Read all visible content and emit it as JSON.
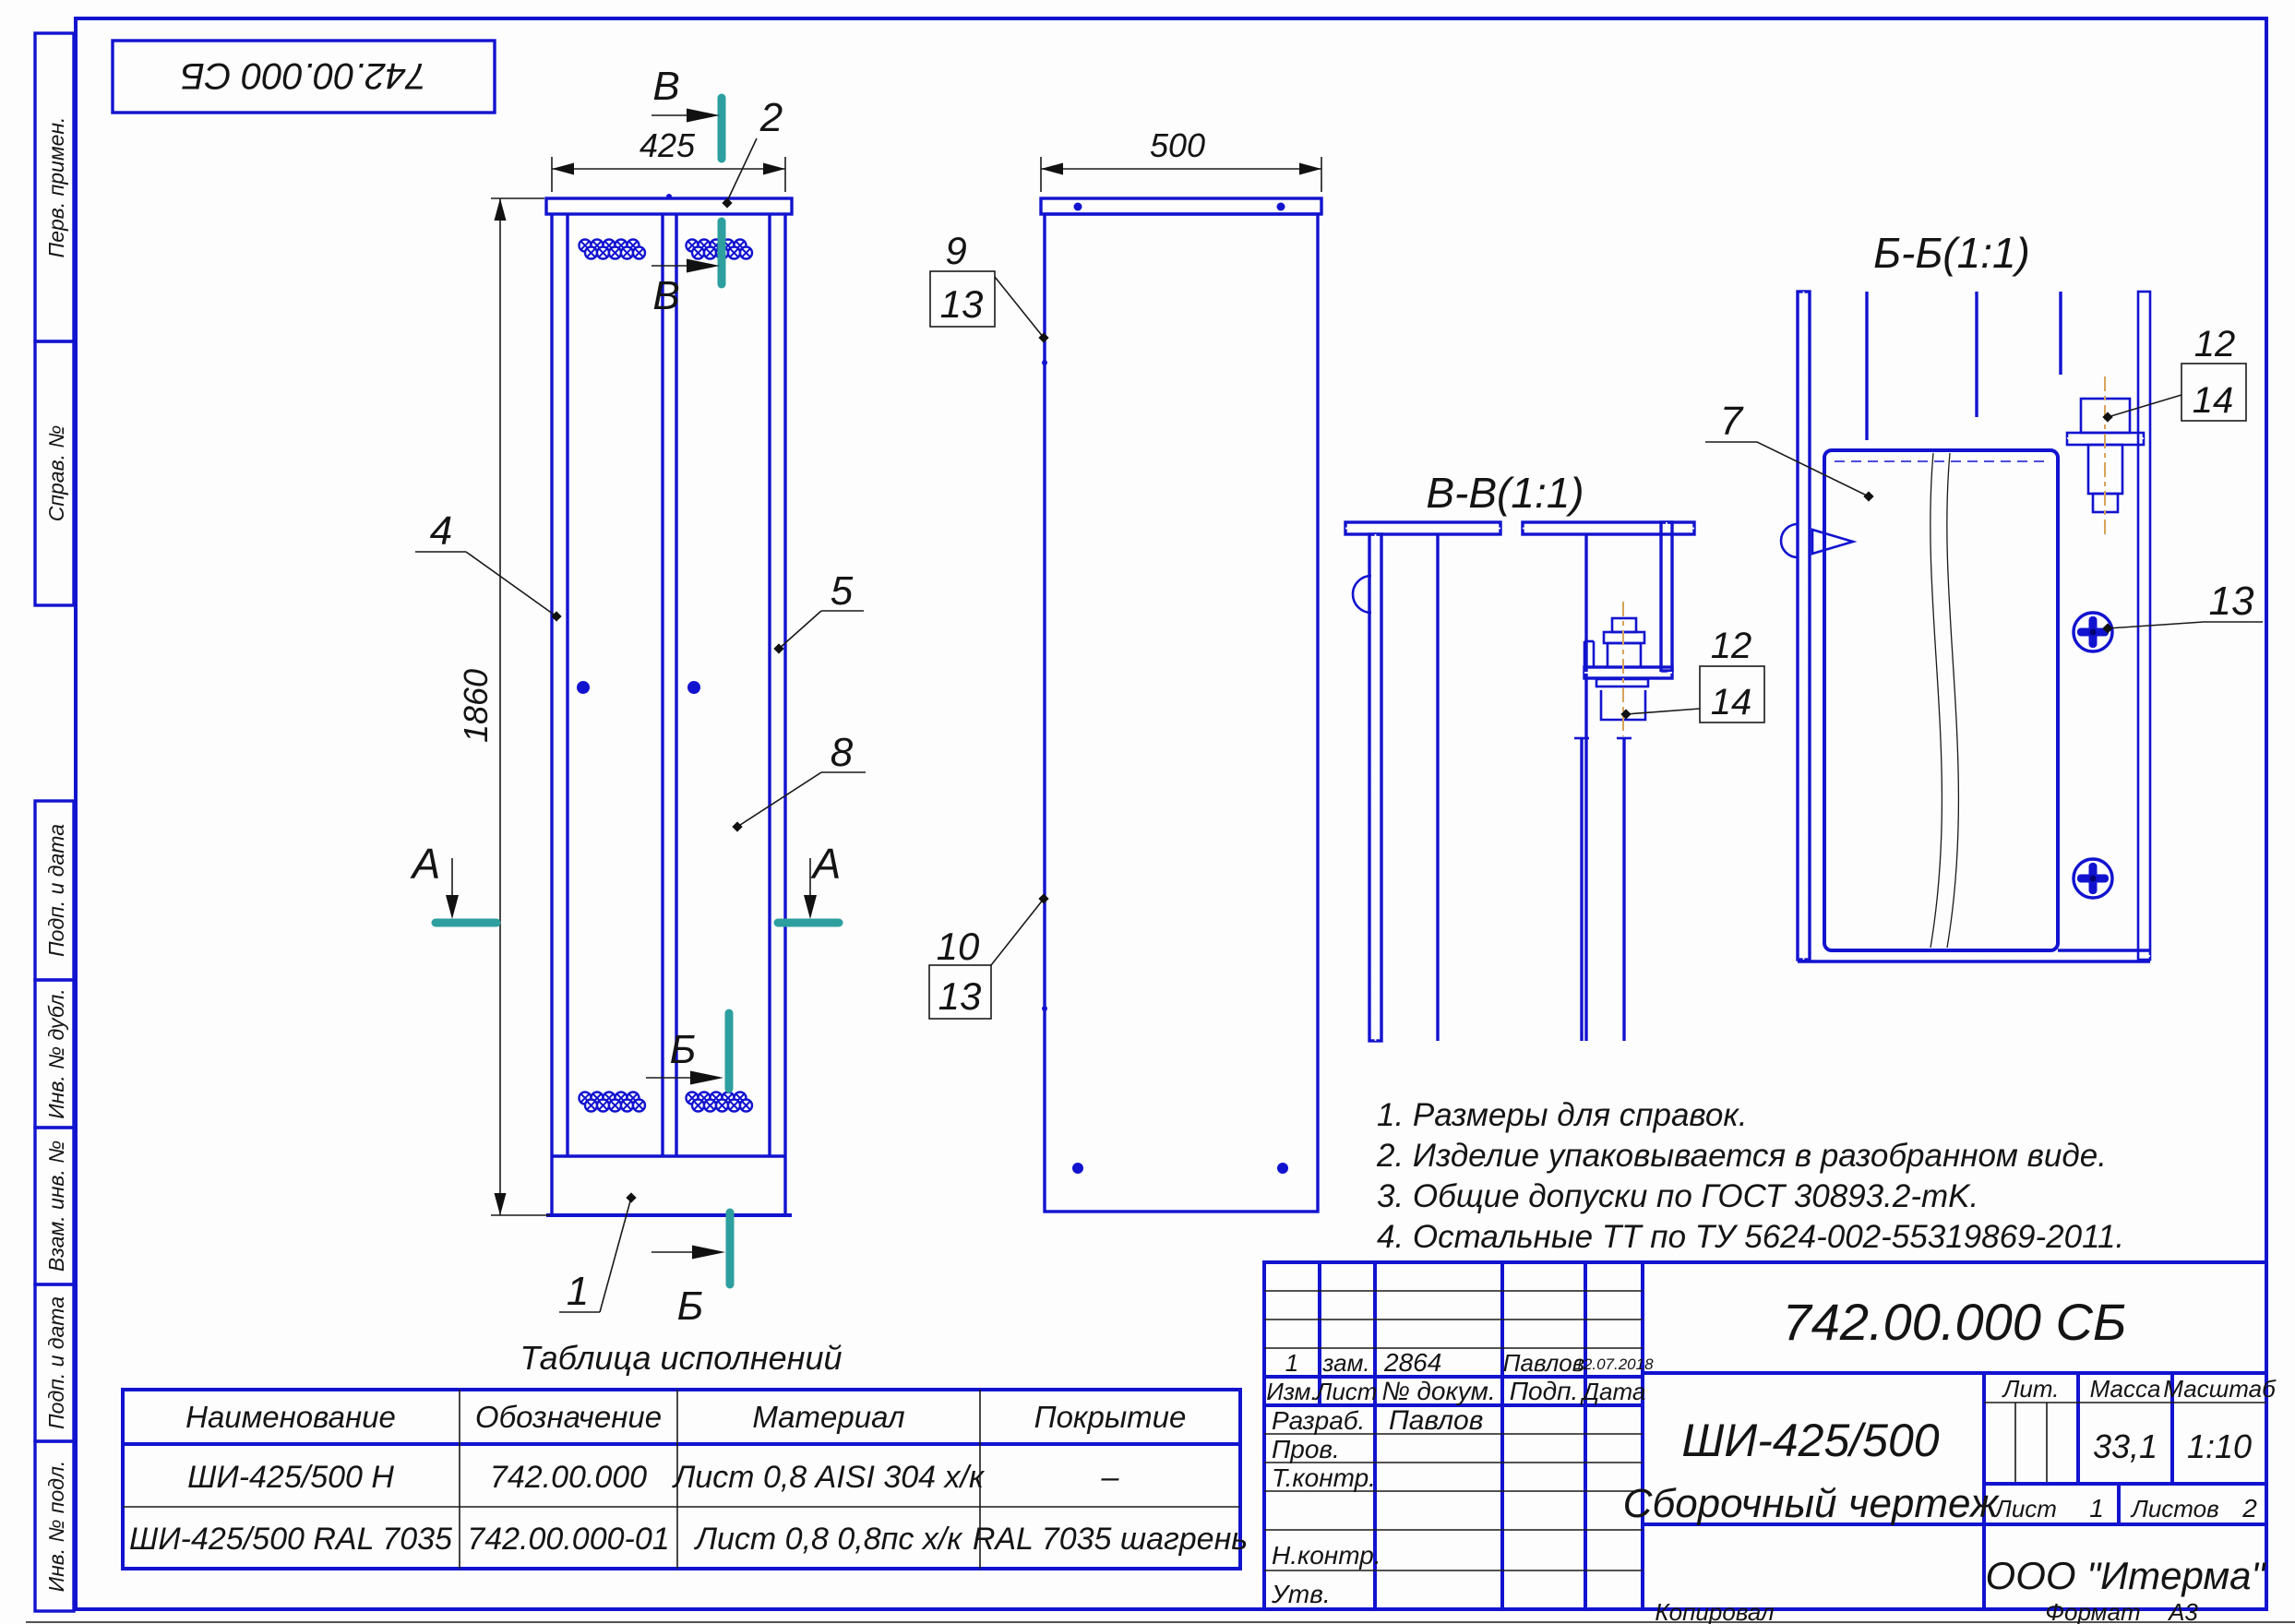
{
  "stamp": {
    "doc_number": "742.00.000 СБ"
  },
  "sidebar": {
    "labels": [
      "Перв. примен.",
      "Справ. №",
      "Подп. и дата",
      "Инв. № дубл.",
      "Взам. инв. №",
      "Подп. и дата",
      "Инв. № подл."
    ]
  },
  "views": {
    "front": {
      "dim_width": "425",
      "dim_height": "1860"
    },
    "side": {
      "dim_depth": "500"
    },
    "section_vv_label": "В-В(1:1)",
    "section_bb_label": "Б-Б(1:1)",
    "marks": {
      "a": "А",
      "b": "Б",
      "v": "В"
    },
    "callouts": {
      "c1": "1",
      "c2": "2",
      "c4": "4",
      "c5": "5",
      "c7": "7",
      "c8": "8",
      "c9": "9",
      "c10": "10",
      "c12": "12",
      "c13": "13",
      "c14": "14"
    }
  },
  "notes": [
    "1. Размеры для справок.",
    "2. Изделие упаковывается в разобранном виде.",
    "3. Общие допуски по ГОСТ 30893.2-mK.",
    "4. Остальные ТТ по ТУ 5624-002-55319869-2011."
  ],
  "spec_table": {
    "title": "Таблица исполнений",
    "headers": [
      "Наименование",
      "Обозначение",
      "Материал",
      "Покрытие"
    ],
    "rows": [
      [
        "ШИ-425/500 Н",
        "742.00.000",
        "Лист 0,8 AISI 304 х/к",
        "–"
      ],
      [
        "ШИ-425/500 RAL 7035",
        "742.00.000-01",
        "Лист 0,8 0,8пс х/к",
        "RAL 7035 шагрень"
      ]
    ]
  },
  "title_block": {
    "doc_number": "742.00.000 СБ",
    "product_name": "ШИ-425/500",
    "doc_type": "Сборочный чертеж",
    "company": "ООО \"Итерма\"",
    "change_row": {
      "izm": "1",
      "type": "зам.",
      "doc_no": "2864",
      "sign": "Павлов",
      "date": "12.07.2018"
    },
    "columns": {
      "izm": "Изм.",
      "list": "Лист",
      "doc": "№ докум.",
      "sign": "Подп.",
      "date": "Дата"
    },
    "roles": {
      "razrab": "Разраб.",
      "prov": "Пров.",
      "tkontr": "Т.контр.",
      "nkontr": "Н.контр.",
      "utv": "Утв."
    },
    "razrab_name": "Павлов",
    "lit_label": "Лит.",
    "mass_label": "Масса",
    "scale_label": "Масштаб",
    "mass_value": "33,1",
    "scale_value": "1:10",
    "sheet_label": "Лист",
    "sheet_value": "1",
    "sheets_label": "Листов",
    "sheets_value": "2"
  },
  "footer": {
    "copied": "Копировал",
    "format_label": "Формат",
    "format_value": "А3"
  },
  "colors": {
    "line_blue": "#1213cf",
    "black": "#1a1a1a",
    "teal": "#2d9f9f",
    "centerline_orange": "#d8a35a"
  }
}
